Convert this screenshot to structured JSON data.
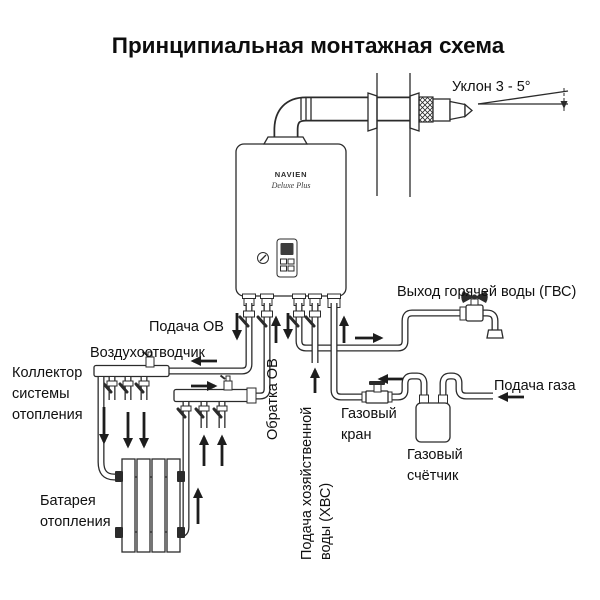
{
  "title": "Принципиальная монтажная схема",
  "colors": {
    "line": "#2b2b2b",
    "text": "#101010",
    "background": "#ffffff"
  },
  "boiler": {
    "brand": "NAVIEN",
    "model": "Deluxe Plus"
  },
  "labels": {
    "slope": "Уклон 3 - 5°",
    "hot_water_out": "Выход горячей воды (ГВС)",
    "heating_supply": "Подача ОВ",
    "air_vent": "Воздухоотводчик",
    "collector_line1": "Коллектор",
    "collector_line2": "системы",
    "collector_line3": "отопления",
    "heating_return": "Обратка ОВ",
    "cold_water_line1": "Подача хозяйственной",
    "cold_water_line2": "воды (ХВС)",
    "gas_valve_line1": "Газовый",
    "gas_valve_line2": "кран",
    "gas_meter_line1": "Газовый",
    "gas_meter_line2": "счётчик",
    "gas_supply": "Подача газа",
    "radiator_line1": "Батарея",
    "radiator_line2": "отопления"
  }
}
